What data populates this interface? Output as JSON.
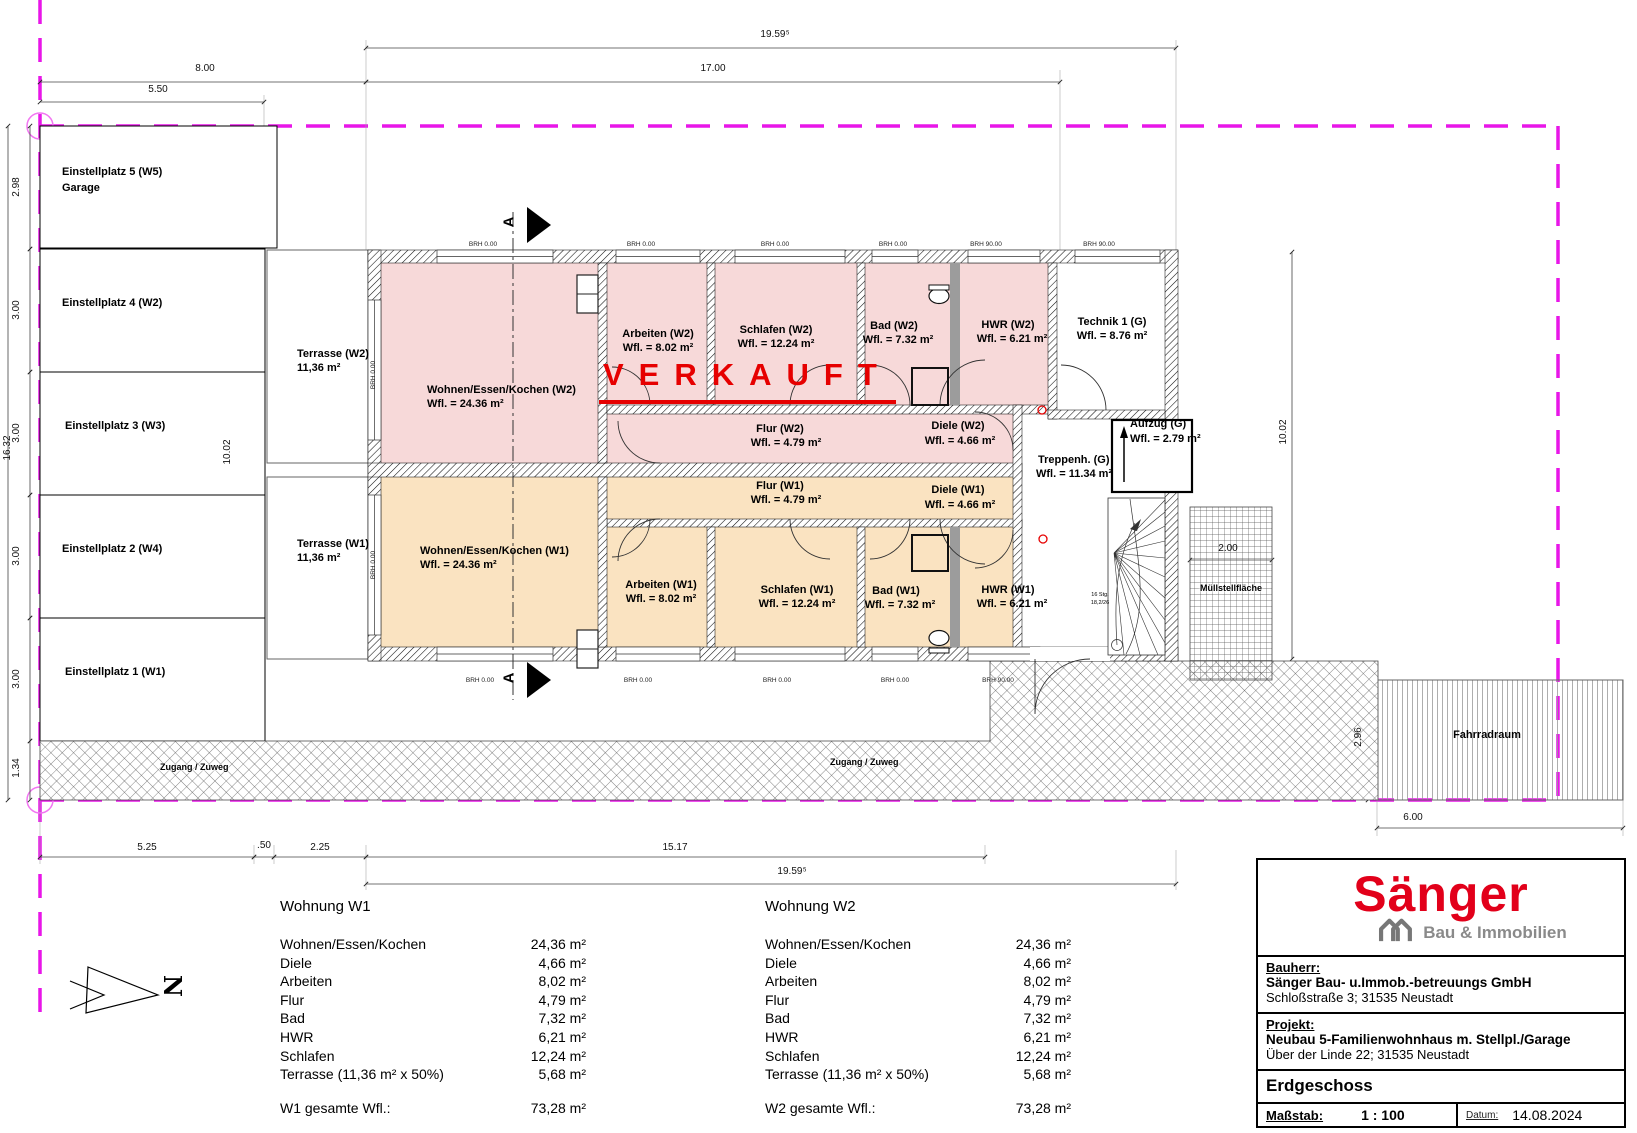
{
  "site": {
    "stalls": [
      {
        "line1": "Einstellplatz 5 (W5)",
        "line2": "Garage"
      },
      {
        "line1": "Einstellplatz 4 (W2)"
      },
      {
        "line1": "Einstellplatz 3 (W3)"
      },
      {
        "line1": "Einstellplatz 2 (W4)"
      },
      {
        "line1": "Einstellplatz 1 (W1)"
      }
    ],
    "walkway1": "Zugang / Zuweg",
    "walkway2": "Zugang / Zuweg",
    "muell": "Müllstellfläche",
    "fahrrad": "Fahrradraum",
    "north_label": "N"
  },
  "stamp": {
    "text": "VERKAUFT",
    "color": "#e60000"
  },
  "rooms": {
    "wek_w2": {
      "name": "Wohnen/Essen/Kochen (W2)",
      "area": "Wfl. = 24.36 m²"
    },
    "arbeiten_w2": {
      "name": "Arbeiten (W2)",
      "area": "Wfl. = 8.02 m²"
    },
    "schlafen_w2": {
      "name": "Schlafen (W2)",
      "area": "Wfl. = 12.24 m²"
    },
    "bad_w2": {
      "name": "Bad (W2)",
      "area": "Wfl. = 7.32 m²"
    },
    "hwr_w2": {
      "name": "HWR (W2)",
      "area": "Wfl. = 6.21 m²"
    },
    "technik": {
      "name": "Technik 1 (G)",
      "area": "Wfl. = 8.76 m²"
    },
    "flur_w2": {
      "name": "Flur (W2)",
      "area": "Wfl. = 4.79 m²"
    },
    "diele_w2": {
      "name": "Diele (W2)",
      "area": "Wfl. = 4.66 m²"
    },
    "treppenhaus": {
      "name": "Treppenh. (G)",
      "area": "Wfl. = 11.34 m²"
    },
    "aufzug": {
      "name": "Aufzug (G)",
      "area": "Wfl. = 2.79 m²"
    },
    "flur_w1": {
      "name": "Flur (W1)",
      "area": "Wfl. = 4.79 m²"
    },
    "diele_w1": {
      "name": "Diele (W1)",
      "area": "Wfl. = 4.66 m²"
    },
    "wek_w1": {
      "name": "Wohnen/Essen/Kochen (W1)",
      "area": "Wfl. = 24.36 m²"
    },
    "arbeiten_w1": {
      "name": "Arbeiten (W1)",
      "area": "Wfl. = 8.02 m²"
    },
    "schlafen_w1": {
      "name": "Schlafen (W1)",
      "area": "Wfl. = 12.24 m²"
    },
    "bad_w1": {
      "name": "Bad (W1)",
      "area": "Wfl. = 7.32 m²"
    },
    "hwr_w1": {
      "name": "HWR (W1)",
      "area": "Wfl. = 6.21 m²"
    },
    "terrasse_w2": {
      "name": "Terrasse (W2)",
      "area": "11,36 m²"
    },
    "terrasse_w1": {
      "name": "Terrasse (W1)",
      "area": "11,36 m²"
    }
  },
  "dims": {
    "d1959": "19.59⁵",
    "d17": "17.00",
    "d8": "8.00",
    "d550": "5.50",
    "d298": "2.98",
    "d300": "3.00",
    "d1632": "16.32",
    "d134": "1.34",
    "d1002": "10.02",
    "d200": "2.00",
    "d296": "2.96",
    "d600": "6.00",
    "d525": "5.25",
    "d050": ".50",
    "d225": "2.25",
    "d1517": "15.17"
  },
  "annotations": {
    "brh0": "BRH 0.00",
    "brh90": "BRH 90.00",
    "stair1": "16 Stg.",
    "stair2": "18,2/26",
    "section": "A"
  },
  "tables": {
    "w1": {
      "title": "Wohnung W1",
      "rows": [
        [
          "Wohnen/Essen/Kochen",
          "24,36 m²"
        ],
        [
          "Diele",
          "4,66 m²"
        ],
        [
          "Arbeiten",
          "8,02 m²"
        ],
        [
          "Flur",
          "4,79 m²"
        ],
        [
          "Bad",
          "7,32 m²"
        ],
        [
          "HWR",
          "6,21 m²"
        ],
        [
          "Schlafen",
          "12,24 m²"
        ],
        [
          "Terrasse (11,36 m² x 50%)",
          "5,68 m²"
        ]
      ],
      "total_label": "W1 gesamte Wfl.:",
      "total_value": "73,28 m²"
    },
    "w2": {
      "title": "Wohnung W2",
      "rows": [
        [
          "Wohnen/Essen/Kochen",
          "24,36 m²"
        ],
        [
          "Diele",
          "4,66 m²"
        ],
        [
          "Arbeiten",
          "8,02 m²"
        ],
        [
          "Flur",
          "4,79 m²"
        ],
        [
          "Bad",
          "7,32 m²"
        ],
        [
          "HWR",
          "6,21 m²"
        ],
        [
          "Schlafen",
          "12,24 m²"
        ],
        [
          "Terrasse (11,36 m² x 50%)",
          "5,68 m²"
        ]
      ],
      "total_label": "W2 gesamte Wfl.:",
      "total_value": "73,28 m²"
    }
  },
  "titleblock": {
    "logo_text": "Sänger",
    "logo_sub": "Bau & Immobilien",
    "bauherr_label": "Bauherr:",
    "bauherr_line1": "Sänger Bau- u.Immob.-betreuungs GmbH",
    "bauherr_line2": "Schloßstraße 3; 31535 Neustadt",
    "projekt_label": "Projekt:",
    "projekt_line1": "Neubau 5-Familienwohnhaus m. Stellpl./Garage",
    "projekt_line2": "Über der Linde 22; 31535 Neustadt",
    "floor": "Erdgeschoss",
    "scale_label": "Maßstab:",
    "scale_value": "1 : 100",
    "date_label": "Datum:",
    "date_value": "14.08.2024",
    "brand_red": "#e2001a"
  },
  "colors": {
    "w2_fill": "#f7d9d9",
    "w1_fill": "#fae3c1",
    "boundary_magenta": "#e816e8",
    "stamp_red": "#e60000"
  }
}
